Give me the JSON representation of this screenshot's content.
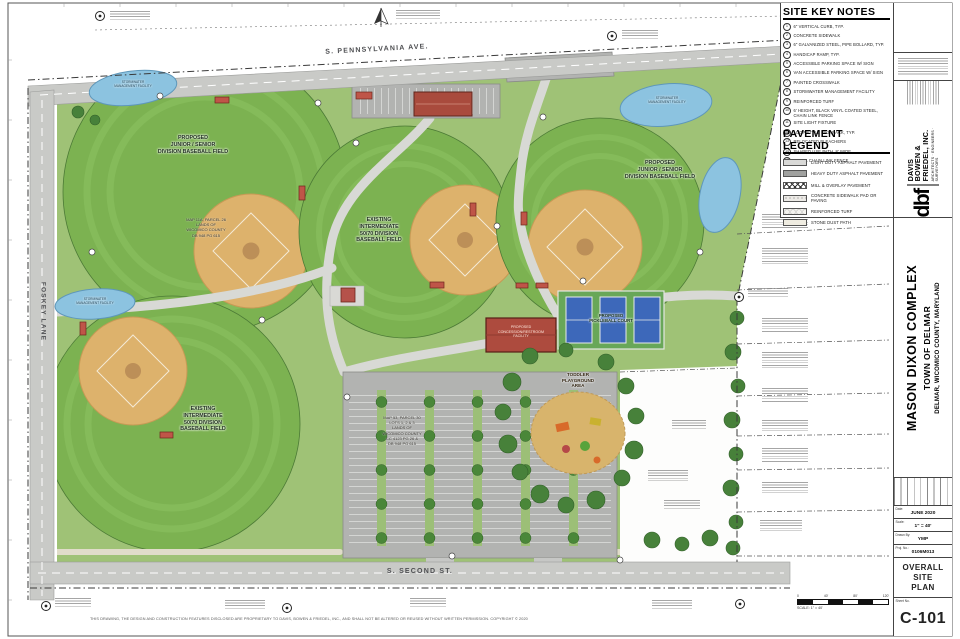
{
  "sheet": {
    "domain": "civil site plan drawing"
  },
  "site_key_notes": {
    "title": "SITE KEY NOTES",
    "items": [
      {
        "num": "1",
        "text": "6\" VERTICAL CURB, TYP."
      },
      {
        "num": "2",
        "text": "CONCRETE SIDEWALK"
      },
      {
        "num": "3",
        "text": "6\" GALVANIZED STEEL, PIPE BOLLARD, TYP."
      },
      {
        "num": "4",
        "text": "HANDICAP RAMP, TYP."
      },
      {
        "num": "5",
        "text": "ACCESSIBLE PARKING SPACE W/ SIGN"
      },
      {
        "num": "6",
        "text": "VAN ACCESSIBLE PARKING SPACE W/ SIGN"
      },
      {
        "num": "7",
        "text": "PAINTED CROSSWALK"
      },
      {
        "num": "8",
        "text": "STORMWATER MANAGEMENT FACILITY"
      },
      {
        "num": "9",
        "text": "REINFORCED TURF"
      },
      {
        "num": "10",
        "text": "6' HEIGHT, BLACK VINYL COATED STEEL, CHAIN LINK FENCE"
      },
      {
        "num": "11",
        "text": "SITE LIGHT FIXTURE"
      },
      {
        "num": "12",
        "text": "LOOP STYLE BIKE RACK, TYP."
      },
      {
        "num": "13",
        "text": "RELOCATED BLEACHERS"
      },
      {
        "num": "14",
        "text": "SHARED USE PATH, 8' WIDE"
      },
      {
        "num": "15",
        "text": "4' TALL CHAIN LINK FENCE"
      }
    ]
  },
  "pavement_legend": {
    "title": "PAVEMENT LEGEND",
    "items": [
      {
        "label": "LIGHT DUTY ASPHALT PAVEMENT"
      },
      {
        "label": "HEAVY DUTY ASPHALT PAVEMENT"
      },
      {
        "label": "MILL & OVERLAY PAVEMENT"
      },
      {
        "label": "CONCRETE SIDEWALK PAD OR PAVING"
      },
      {
        "label": "REINFORCED TURF"
      },
      {
        "label": "STONE DUST PATH"
      }
    ]
  },
  "plan": {
    "streets": {
      "top": "S. PENNSYLVANIA AVE.",
      "left": "FOSKEY LANE",
      "bottom": "S. SECOND ST."
    },
    "fields": {
      "northwest": "PROPOSED\nJUNIOR / SENIOR\nDIVISION BASEBALL FIELD",
      "center": "EXISTING\nINTERMEDIATE\n50/70 DIVISION\nBASEBALL FIELD",
      "east": "PROPOSED\nJUNIOR / SENIOR\nDIVISION BASEBALL FIELD",
      "southwest": "EXISTING\nINTERMEDIATE\n50/70 DIVISION\nBASEBALL FIELD"
    },
    "features": {
      "pickleball": "PROPOSED\nPICKLEBALL COURT",
      "playground": "TODDLER\nPLAYGROUND\nAREA",
      "concession": "PROPOSED\nCONCESSION/RESTROOM\nFACILITY",
      "stormwater": "STORMWATER\nMANAGEMENT FACILITY"
    },
    "parcels": {
      "northwest": "MAP 11A, PARCEL 26\nLANDS OF\nWICOMICO COUNTY\nDB 948 PG 615",
      "parking": "MAP 53, PARCEL 30\nLOTS 1, 2 & 3\nLANDS OF\nWICOMICO COUNTY\nCC 4123 PG 26 &\nDB 948 PG 615"
    },
    "scale_bar": {
      "label": "SCALE: 1\" = 40'",
      "ticks": [
        "0",
        "40'",
        "80'",
        "120'"
      ]
    },
    "colors": {
      "turf_green": "#7cb251",
      "rough_green": "#9fc276",
      "infield_tan": "#ddb26c",
      "pond_blue": "#8cc3e0",
      "road_gray": "#c9cac7",
      "parking_gray": "#b2b3b1",
      "building_red": "#ad4b3e",
      "court_blue": "#3d68ba",
      "tree_green": "#47813a"
    }
  },
  "title_block": {
    "firm": {
      "logo": "dbf",
      "name_lines": [
        "DAVIS",
        "BOWEN &",
        "FRIEDEL, INC."
      ],
      "tagline": "ARCHITECTS · ENGINEERS · SURVEYORS"
    },
    "project": {
      "title": "MASON DIXON COMPLEX",
      "line2": "TOWN OF DELMAR",
      "line3": "DELMAR, WICOMICO COUNTY, MARYLAND"
    },
    "fields": {
      "date_label": "Date:",
      "date": "JUNE 2020",
      "scale_label": "Scale:",
      "scale": "1\" = 40'",
      "drawn_label": "Drawn By:",
      "drawn": "YMP",
      "proj_label": "Proj. No.:",
      "proj": "0106M013"
    },
    "sheet_title": "OVERALL SITE\nPLAN",
    "sheet_no_label": "Sheet No.",
    "sheet_no": "C-101"
  },
  "footer": {
    "disclaimer": "THIS DRAWING, THE DESIGN AND CONSTRUCTION FEATURES DISCLOSED ARE PROPRIETARY TO DAVIS, BOWEN & FRIEDEL, INC., AND SHALL NOT BE ALTERED OR REUSED WITHOUT WRITTEN PERMISSION. COPYRIGHT © 2020"
  }
}
